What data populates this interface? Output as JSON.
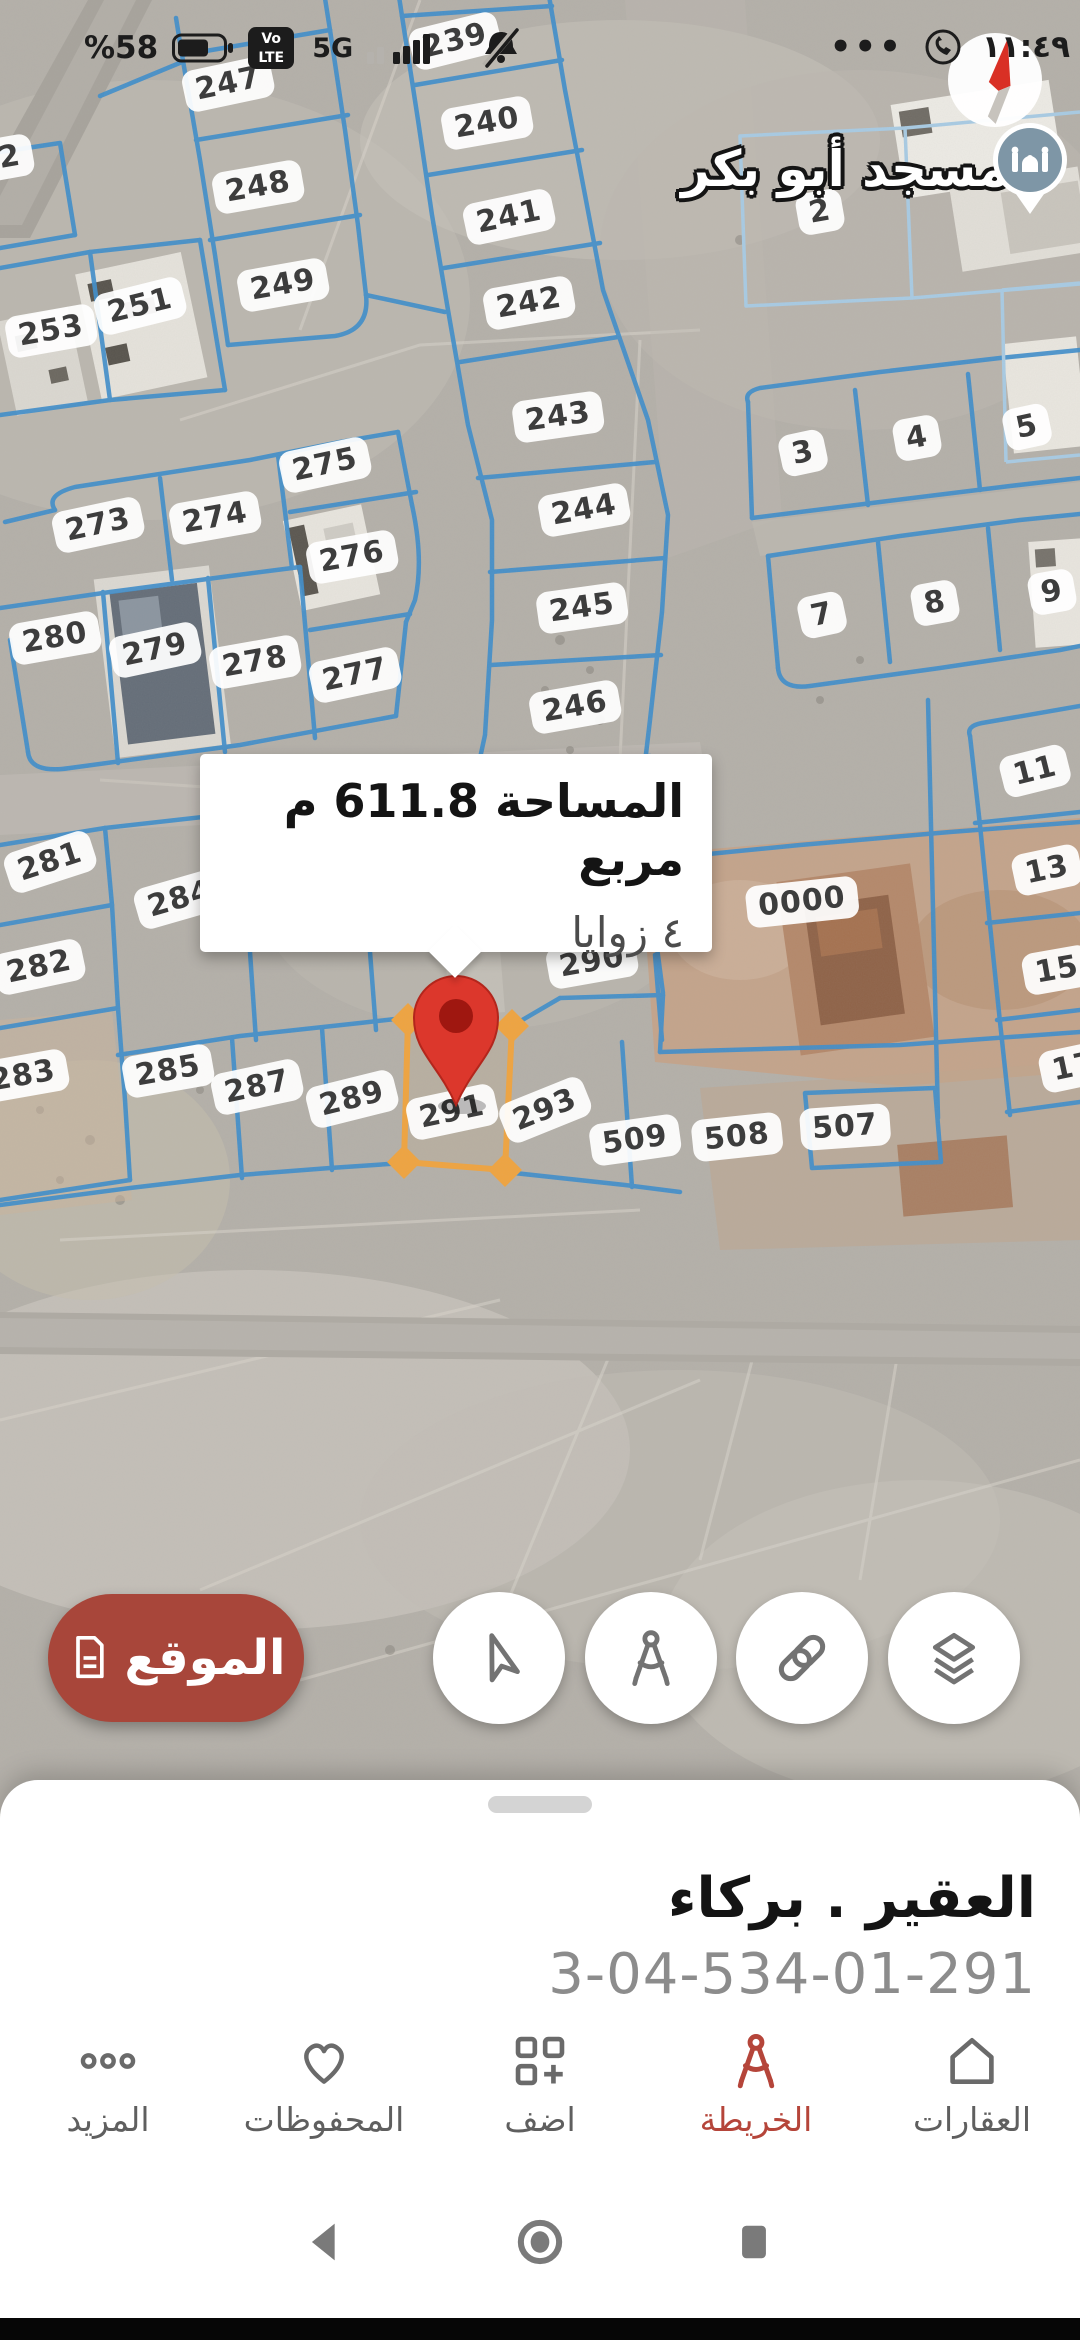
{
  "status_bar": {
    "battery_percent": "%58",
    "volte_line1": "Vo",
    "volte_line2": "LTE",
    "network": "5G",
    "more_dots": "•••",
    "time": "١١:٤٩"
  },
  "map": {
    "mosque_label": "مسجد أبو بكر",
    "callout": {
      "line1": "المساحة 611.8 م مربع",
      "line2": "٤ زوايا"
    },
    "colors": {
      "parcel_blue": "#3f8ecb",
      "parcel_light_blue": "#a8cbe4",
      "selected_orange": "#f0a43f",
      "pin_red": "#dc372c"
    },
    "plots": [
      {
        "n": "239",
        "x": 455,
        "y": 41,
        "r": -14
      },
      {
        "n": "240",
        "x": 487,
        "y": 123,
        "r": -10
      },
      {
        "n": "241",
        "x": 509,
        "y": 217,
        "r": -12
      },
      {
        "n": "242",
        "x": 529,
        "y": 303,
        "r": -10
      },
      {
        "n": "243",
        "x": 558,
        "y": 417,
        "r": -8
      },
      {
        "n": "244",
        "x": 584,
        "y": 510,
        "r": -10
      },
      {
        "n": "245",
        "x": 582,
        "y": 608,
        "r": -8
      },
      {
        "n": "246",
        "x": 575,
        "y": 707,
        "r": -10
      },
      {
        "n": "247",
        "x": 228,
        "y": 84,
        "r": -12
      },
      {
        "n": "248",
        "x": 258,
        "y": 187,
        "r": -10
      },
      {
        "n": "249",
        "x": 283,
        "y": 285,
        "r": -10
      },
      {
        "n": "252",
        "x": -12,
        "y": 161,
        "r": -10
      },
      {
        "n": "251",
        "x": 140,
        "y": 306,
        "r": -14
      },
      {
        "n": "253",
        "x": 51,
        "y": 331,
        "r": -10
      },
      {
        "n": "273",
        "x": 98,
        "y": 525,
        "r": -12
      },
      {
        "n": "274",
        "x": 215,
        "y": 518,
        "r": -10
      },
      {
        "n": "275",
        "x": 325,
        "y": 465,
        "r": -12
      },
      {
        "n": "276",
        "x": 352,
        "y": 557,
        "r": -10
      },
      {
        "n": "277",
        "x": 355,
        "y": 675,
        "r": -12
      },
      {
        "n": "278",
        "x": 255,
        "y": 662,
        "r": -10
      },
      {
        "n": "279",
        "x": 155,
        "y": 650,
        "r": -12
      },
      {
        "n": "280",
        "x": 55,
        "y": 638,
        "r": -10
      },
      {
        "n": "281",
        "x": 50,
        "y": 862,
        "r": -18
      },
      {
        "n": "282",
        "x": 39,
        "y": 967,
        "r": -12
      },
      {
        "n": "283",
        "x": 23,
        "y": 1076,
        "r": -10
      },
      {
        "n": "284",
        "x": 180,
        "y": 899,
        "r": -16
      },
      {
        "n": "285",
        "x": 168,
        "y": 1071,
        "r": -10
      },
      {
        "n": "287",
        "x": 257,
        "y": 1087,
        "r": -12
      },
      {
        "n": "289",
        "x": 352,
        "y": 1099,
        "r": -14
      },
      {
        "n": "290",
        "x": 592,
        "y": 962,
        "r": -10
      },
      {
        "n": "291",
        "x": 452,
        "y": 1112,
        "r": -12
      },
      {
        "n": "293",
        "x": 545,
        "y": 1110,
        "r": -22
      },
      {
        "n": "2",
        "x": 820,
        "y": 212,
        "r": -10
      },
      {
        "n": "3",
        "x": 803,
        "y": 453,
        "r": -12
      },
      {
        "n": "4",
        "x": 917,
        "y": 438,
        "r": -10
      },
      {
        "n": "5",
        "x": 1027,
        "y": 427,
        "r": -12
      },
      {
        "n": "7",
        "x": 822,
        "y": 615,
        "r": -12
      },
      {
        "n": "8",
        "x": 935,
        "y": 603,
        "r": -10
      },
      {
        "n": "9",
        "x": 1052,
        "y": 592,
        "r": -10
      },
      {
        "n": "11",
        "x": 1035,
        "y": 771,
        "r": -14
      },
      {
        "n": "13",
        "x": 1047,
        "y": 870,
        "r": -12
      },
      {
        "n": "15",
        "x": 1057,
        "y": 970,
        "r": -10
      },
      {
        "n": "17",
        "x": 1074,
        "y": 1067,
        "r": -12
      },
      {
        "n": "0000",
        "x": 802,
        "y": 902,
        "r": -6
      },
      {
        "n": "509",
        "x": 635,
        "y": 1140,
        "r": -8
      },
      {
        "n": "508",
        "x": 737,
        "y": 1137,
        "r": -6
      },
      {
        "n": "507",
        "x": 845,
        "y": 1127,
        "r": -4
      }
    ]
  },
  "buttons": {
    "location_label": "الموقع"
  },
  "bottom_sheet": {
    "title": "العقير . بركاء",
    "code": "3-04-534-01-291"
  },
  "nav": {
    "items": [
      {
        "id": "more",
        "label": "المزيد"
      },
      {
        "id": "saved",
        "label": "المحفوظات"
      },
      {
        "id": "add",
        "label": "اضف"
      },
      {
        "id": "map",
        "label": "الخريطة"
      },
      {
        "id": "properties",
        "label": "العقارات"
      }
    ]
  }
}
